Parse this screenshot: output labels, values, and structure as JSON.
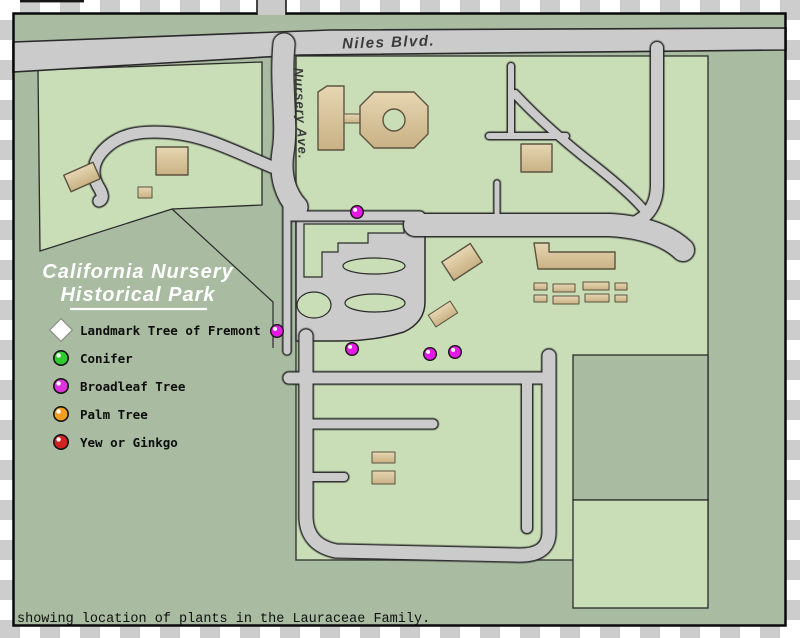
{
  "map": {
    "roads": {
      "niles_label": "Niles Blvd.",
      "nursery_label": "Nursery Ave."
    },
    "title": {
      "line1": "California Nursery",
      "line2": "Historical Park"
    },
    "caption": "showing location of plants in the Lauraceae Family.",
    "dots": {
      "meaning": "Broadleaf Tree location",
      "color": "#e61ae6",
      "ring_color": "#151515",
      "positions": [
        [
          357,
          212
        ],
        [
          277,
          331
        ],
        [
          352,
          349
        ],
        [
          430,
          354
        ],
        [
          455,
          352
        ]
      ]
    }
  },
  "legend": {
    "items": [
      {
        "label": "Landmark Tree of Fremont",
        "marker": "diamond",
        "color": "#ffffff"
      },
      {
        "label": "Conifer",
        "marker": "ball",
        "color": "#2ecc2e"
      },
      {
        "label": "Broadleaf Tree",
        "marker": "ball",
        "color": "#dd33dd"
      },
      {
        "label": "Palm Tree",
        "marker": "ball",
        "color": "#f0a01e"
      },
      {
        "label": "Yew or Ginkgo",
        "marker": "ball",
        "color": "#d22222"
      }
    ]
  },
  "colors": {
    "map_base": "#a9bba1",
    "field": "#c9deb7",
    "road": "#cbcbcb",
    "building": "#d6c29b"
  }
}
